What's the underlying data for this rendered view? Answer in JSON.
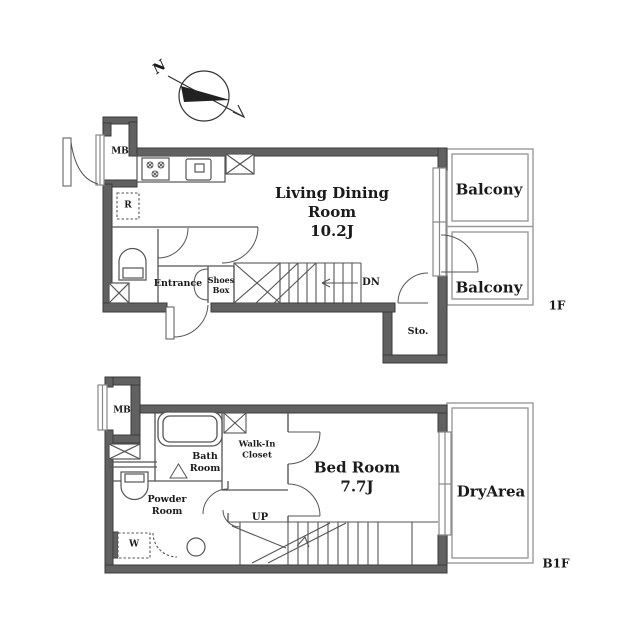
{
  "colors": {
    "wall_fill": "#616161",
    "wall_stroke": "#3a3a3a",
    "thin_line": "#555555",
    "balcony_line": "#999999",
    "text": "#1a1a1a",
    "background": "#ffffff"
  },
  "compass": {
    "north_label": "N"
  },
  "floor_1f": {
    "floor_label": "1F",
    "rooms": {
      "living_dining": {
        "name": "Living Dining Room",
        "area": "10.2J"
      },
      "balcony_upper": {
        "name": "Balcony"
      },
      "balcony_lower": {
        "name": "Balcony"
      },
      "entrance": {
        "name": "Entrance"
      },
      "shoes_box": {
        "name": "Shoes Box"
      },
      "storage": {
        "name": "Sto."
      },
      "meter_box": {
        "name": "MB"
      },
      "refrigerator_space": {
        "name": "R"
      }
    },
    "stairs": {
      "direction_label": "DN"
    }
  },
  "floor_b1f": {
    "floor_label": "B1F",
    "rooms": {
      "bed_room": {
        "name": "Bed Room",
        "area": "7.7J"
      },
      "bath_room": {
        "name": "Bath Room"
      },
      "walk_in_closet": {
        "name": "Walk-In Closet"
      },
      "powder_room": {
        "name": "Powder Room"
      },
      "dry_area": {
        "name": "DryArea"
      },
      "meter_box": {
        "name": "MB"
      },
      "washer": {
        "name": "W"
      }
    },
    "stairs": {
      "direction_label": "UP"
    }
  }
}
